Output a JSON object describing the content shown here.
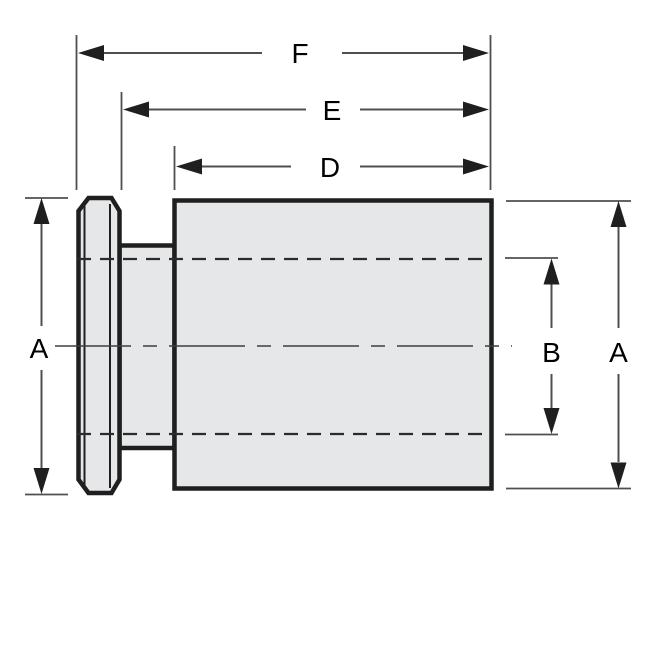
{
  "drawing": {
    "part_fill": "#e6e7e8",
    "outline_color": "#1f1f1f",
    "dimension_color": "#4f4f4f",
    "label_color": "#000000",
    "labels": {
      "f": "F",
      "e": "E",
      "d": "D",
      "a_left": "A",
      "b": "B",
      "a_right": "A"
    }
  }
}
